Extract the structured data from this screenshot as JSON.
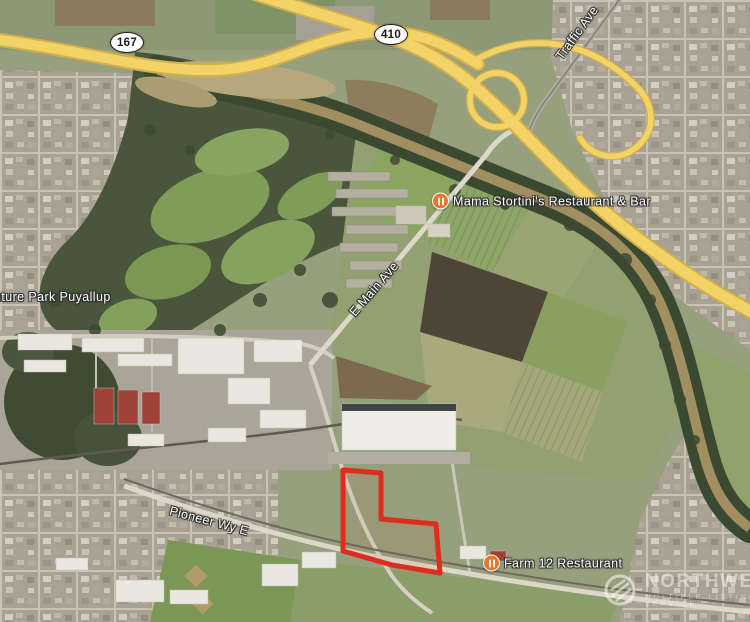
{
  "map": {
    "type": "satellite-aerial-photo",
    "shields": [
      {
        "icon": "route-shield",
        "route": "167"
      },
      {
        "icon": "route-shield",
        "route": "410"
      }
    ],
    "road_labels": [
      {
        "text": "Traffic Ave"
      },
      {
        "text": "E Main Ave"
      },
      {
        "text": "Pioneer Wy E"
      }
    ],
    "place_labels": [
      {
        "text": "nture Park Puyallup"
      },
      {
        "text": "Mama Stortini's Restaurant & Bar",
        "icon": "restaurant-icon"
      },
      {
        "text": "Farm 12 Restaurant",
        "icon": "restaurant-icon"
      }
    ],
    "property_outline": {
      "color": "#dc2e1e",
      "shape": "L-shaped parcel south of warehouse"
    },
    "watermark": {
      "icon": "nwmls-logo",
      "line1": "NORTHWEST",
      "line2": "MULTIPLE LISTING SERVICE"
    },
    "colors": {
      "highway": "#f2d466",
      "poi_icon": "#e8772e",
      "property_outline": "#dc2e1e"
    }
  }
}
